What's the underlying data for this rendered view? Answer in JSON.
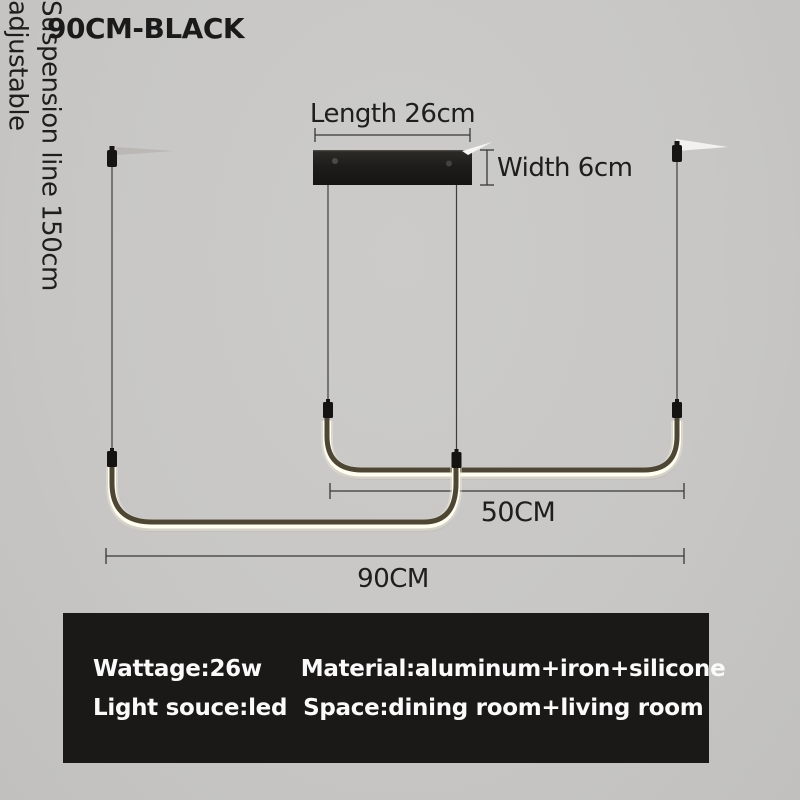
{
  "variant_title": "90CM-BLACK",
  "dimensions": {
    "length": "Length 26cm",
    "width": "Width 6cm",
    "suspension_line": "Suspension line 150cm",
    "suspension_note": "adjustable",
    "upper_tube_length": "50CM",
    "overall_length": "90CM"
  },
  "specs": {
    "wattage": "Wattage:26w",
    "material": "Material:aluminum+iron+silicone",
    "light_source": "Light souce:led",
    "space": "Space:dining room+living room"
  },
  "colors": {
    "background": "#c8c7c5",
    "annotation_text": "#1e1e1e",
    "dimension_line": "#383838",
    "canopy_black": "#1f1d1b",
    "tube_body": "#4d4634",
    "led_glow": "#fffdf0",
    "spec_box_bg": "#1b1918",
    "spec_box_text": "#fafafa"
  }
}
